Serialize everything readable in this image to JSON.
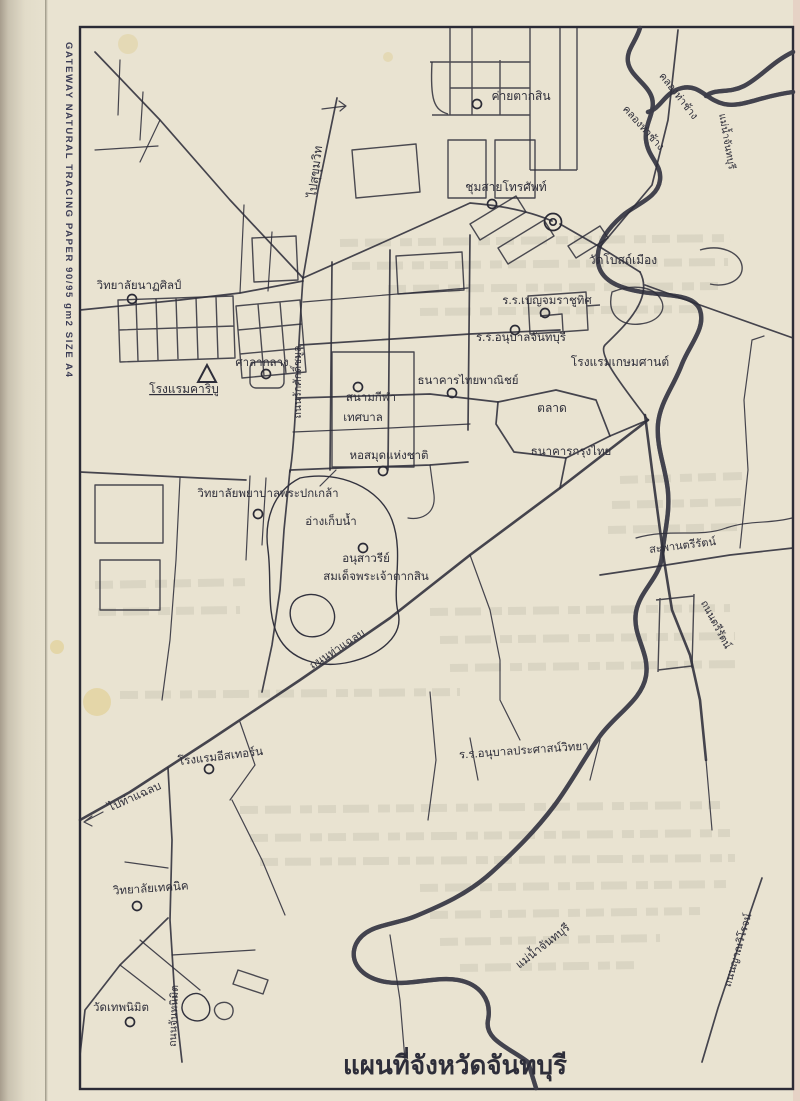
{
  "page": {
    "brand_vertical_text": "GATEWAY NATURAL TRACING PAPER 90/95 gm2 SIZE A4",
    "title": "แผนที่จังหวัดจันทบุรี"
  },
  "map": {
    "ink": "#2e2e3a",
    "paper": "#e9e3d1",
    "labels": [
      {
        "name": "khlong-tha-chang-upper",
        "text": "คลองท่าช้าง",
        "x": 676,
        "y": 98,
        "rot": 52,
        "size": 10.5
      },
      {
        "name": "khlong-tha-chang-lower",
        "text": "คลองท่าช้าง",
        "x": 641,
        "y": 130,
        "rot": 48,
        "size": 10.5
      },
      {
        "name": "mae-nam-chanthaburi-upper",
        "text": "แม่น้ำจันทบุรี",
        "x": 724,
        "y": 142,
        "rot": 80,
        "size": 10
      },
      {
        "name": "pai-sukhumvit",
        "text": "ไปสุขุมวิท",
        "x": 319,
        "y": 172,
        "rot": -83,
        "size": 12
      },
      {
        "name": "khai-taksin",
        "text": "ค่ายตากสิน",
        "x": 521,
        "y": 100,
        "size": 12
      },
      {
        "name": "chumsai-thorasap",
        "text": "ชุมสายโทรศัพท์",
        "x": 506,
        "y": 191,
        "size": 12
      },
      {
        "name": "wat-bot-mueang",
        "text": "วัดโบสถ์เมือง",
        "x": 623,
        "y": 264,
        "size": 12
      },
      {
        "name": "rr-benchamarachuthit",
        "text": "ร.ร.เบญจมราชูทิศ",
        "x": 547,
        "y": 304,
        "size": 11.5
      },
      {
        "name": "rr-anuban-chanthaburi",
        "text": "ร.ร.อนุบาลจันทบุรี",
        "x": 521,
        "y": 341,
        "size": 11.5
      },
      {
        "name": "rongraem-kasemsan",
        "text": "โรงแรมเกษมศานต์",
        "x": 620,
        "y": 366,
        "size": 12
      },
      {
        "name": "thanakhan-thai-phanit",
        "text": "ธนาคารไทยพาณิชย์",
        "x": 468,
        "y": 384,
        "size": 11.5
      },
      {
        "name": "talat",
        "text": "ตลาด",
        "x": 552,
        "y": 412,
        "size": 12
      },
      {
        "name": "thanakhan-krungthai",
        "text": "ธนาคารกรุงไทย",
        "x": 571,
        "y": 455,
        "size": 11.5
      },
      {
        "name": "witthayalai-natasin",
        "text": "วิทยาลัยนาฏศิลป์",
        "x": 139,
        "y": 289,
        "size": 11.5
      },
      {
        "name": "rongraem-caribou",
        "text": "โรงแรมคาริบู",
        "x": 184,
        "y": 393,
        "size": 12,
        "underline": true
      },
      {
        "name": "sala-klang",
        "text": "ศาลากลาง",
        "x": 262,
        "y": 366,
        "size": 11.5
      },
      {
        "name": "thanon-rak-sak-chamun",
        "text": "ถนนรักศักดิ์ชมูล",
        "x": 301,
        "y": 382,
        "rot": -90,
        "size": 10.5
      },
      {
        "name": "sanam-kila-line1",
        "text": "สนามกีฬา",
        "x": 371,
        "y": 401,
        "size": 11.5
      },
      {
        "name": "sanam-kila-line2",
        "text": "เทศบาล",
        "x": 363,
        "y": 421,
        "size": 11.5
      },
      {
        "name": "ho-samut-haeng-chat",
        "text": "หอสมุดแห่งชาติ",
        "x": 389,
        "y": 459,
        "size": 11.5
      },
      {
        "name": "witthayalai-phayaban",
        "text": "วิทยาลัยพยาบาลพระปกเกล้า",
        "x": 268,
        "y": 497,
        "size": 11.5
      },
      {
        "name": "ang-kep-nam",
        "text": "อ่างเก็บน้ำ",
        "x": 331,
        "y": 525,
        "size": 11.5
      },
      {
        "name": "anusawari-line1",
        "text": "อนุสาวรีย์",
        "x": 366,
        "y": 562,
        "size": 11.5
      },
      {
        "name": "anusawari-line2",
        "text": "สมเด็จพระเจ้าตากสิน",
        "x": 376,
        "y": 580,
        "size": 11.5
      },
      {
        "name": "thanon-tha-chalaep",
        "text": "ถนนท่าแฉลบ",
        "x": 339,
        "y": 652,
        "rot": -33,
        "size": 11
      },
      {
        "name": "saphan-trirat",
        "text": "สะพานตรีรัตน์",
        "x": 683,
        "y": 549,
        "rot": -7,
        "size": 11
      },
      {
        "name": "thanon-trirat",
        "text": "ถนนตรีรัตน์",
        "x": 713,
        "y": 626,
        "rot": 62,
        "size": 10.5
      },
      {
        "name": "rongraem-eastern",
        "text": "โรงแรมอีสเทอร์น",
        "x": 221,
        "y": 760,
        "rot": -7,
        "size": 11.5
      },
      {
        "name": "rr-anuban-prasat-witthaya",
        "text": "ร.ร.อนุบาลประศาสน์วิทยา",
        "x": 524,
        "y": 754,
        "rot": -4,
        "size": 11.5
      },
      {
        "name": "pai-tha-chalaep",
        "text": "ไปท่าแฉลบ",
        "x": 136,
        "y": 800,
        "rot": -24,
        "size": 11.5
      },
      {
        "name": "witthayalai-technic",
        "text": "วิทยาลัยเทคนิค",
        "x": 151,
        "y": 892,
        "rot": -4,
        "size": 11.5
      },
      {
        "name": "wat-thep-nimit",
        "text": "วัดเทพนิมิต",
        "x": 121,
        "y": 1011,
        "size": 11.5
      },
      {
        "name": "thanon-chan-nimit",
        "text": "ถนนจันทนิมิต",
        "x": 177,
        "y": 1016,
        "rot": -88,
        "size": 10.5
      },
      {
        "name": "thanon-yan-wirot",
        "text": "ถนนญาณวิโรจน์",
        "x": 741,
        "y": 951,
        "rot": -74,
        "size": 10.5
      },
      {
        "name": "mae-nam-chanthaburi-lower",
        "text": "แม่น้ำจันทบุรี",
        "x": 545,
        "y": 949,
        "rot": -38,
        "size": 11.5
      },
      {
        "name": "map-title",
        "text": "แผนที่จังหวัดจันทบุรี",
        "x": 455,
        "y": 1074,
        "size": 26,
        "bold": true
      }
    ],
    "markers": {
      "circles": [
        [
          477,
          104
        ],
        [
          492,
          204
        ],
        [
          545,
          313
        ],
        [
          515,
          330
        ],
        [
          452,
          393
        ],
        [
          132,
          299
        ],
        [
          266,
          374
        ],
        [
          358,
          387
        ],
        [
          383,
          471
        ],
        [
          258,
          514
        ],
        [
          363,
          548
        ],
        [
          209,
          769
        ],
        [
          137,
          906
        ],
        [
          130,
          1022
        ]
      ],
      "triangle": [
        207,
        374
      ],
      "roundabout": [
        553,
        222
      ]
    }
  }
}
